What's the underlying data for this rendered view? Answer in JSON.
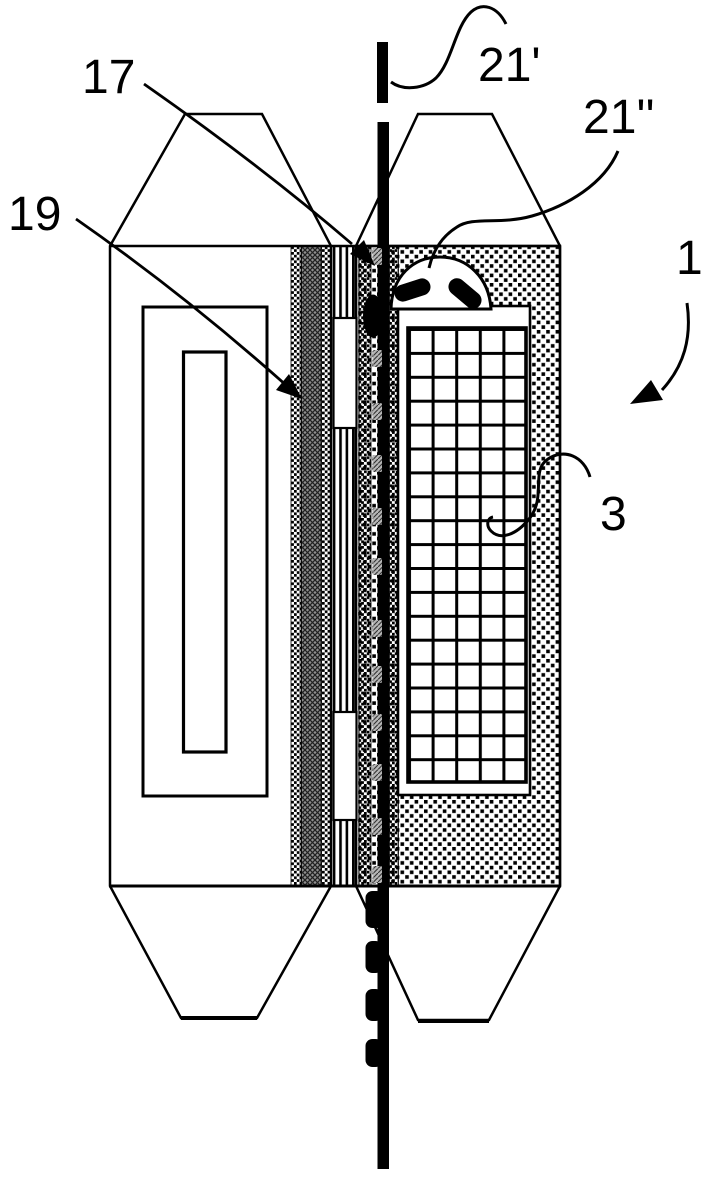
{
  "figure": {
    "kind": "patent-style cross-section drawing of a wire/thread passing between two device halves",
    "labels": {
      "ref17": "17",
      "ref19": "19",
      "ref21p": "21'",
      "ref21pp": "21''",
      "ref1": "1",
      "ref3": "3"
    },
    "colors": {
      "ink": "#000000",
      "paper": "#ffffff",
      "hatch_gray": "#8f8f8f",
      "speck_gray": "#b5b5b5"
    }
  }
}
